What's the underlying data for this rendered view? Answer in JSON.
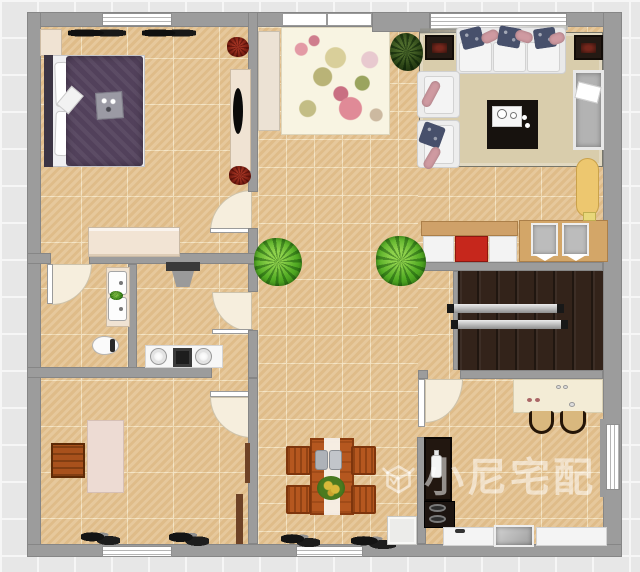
{
  "watermark": {
    "text": "小尼宅配",
    "logo": "open-box-check-logo",
    "color": "rgba(255,255,255,0.52)"
  },
  "palette": {
    "wall": "#9c9c9c",
    "floor": "#e3c292",
    "grout": "#f3e2c0",
    "balcony": "#33231a",
    "rug-living": "#d9cdac",
    "rug-floral": "#f8f4e2",
    "bed": "#52415b",
    "pillow-navy": "#47506b",
    "pillow-pink": "#cf9aa1",
    "wood": "#b5571f",
    "cabinet-red": "#c6271c",
    "counter-cream": "#f3ecd6",
    "counter-dark": "#221710",
    "watermark": "rgba(255,255,255,0.52)"
  },
  "rooms": {
    "bedroom": [
      "double-bed",
      "nightstands",
      "wardrobe",
      "tv-console",
      "tv",
      "wall-speakers",
      "red-plants",
      "window"
    ],
    "living-room": [
      "sofa",
      "armchairs",
      "coffee-table",
      "tea-tray",
      "side-tables",
      "chaise-lounge",
      "ironing-board",
      "area-rug",
      "window"
    ],
    "foyer-hallway": [
      "entry-door",
      "floral-rug",
      "runner-mat",
      "potted-plants"
    ],
    "bathroom": [
      "vanity-two-sinks",
      "toilet",
      "door"
    ],
    "laundry-room": [
      "water-heater",
      "double-sink-counter",
      "washer",
      "door"
    ],
    "study-room": [
      "desk",
      "wooden-chair",
      "wall-shelves",
      "shoes",
      "window"
    ],
    "dining-area": [
      "dining-table",
      "table-runner",
      "four-chairs",
      "centerpiece",
      "shoes",
      "window"
    ],
    "balcony": [
      "drying-rods"
    ],
    "kitchen": [
      "bar-counter",
      "bar-stools",
      "tall-dark-counter",
      "bottle",
      "stove",
      "sink",
      "counters",
      "window",
      "door"
    ]
  }
}
